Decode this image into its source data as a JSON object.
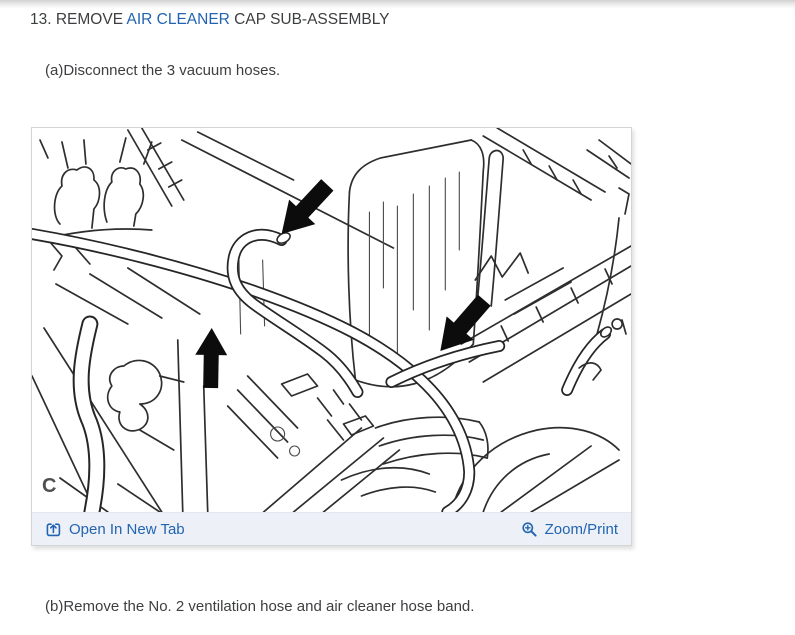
{
  "heading": {
    "prefix": "13. REMOVE ",
    "link": "AIR CLEANER",
    "suffix": " CAP SUB-ASSEMBLY"
  },
  "steps": {
    "a": "(a)Disconnect the 3 vacuum hoses.",
    "b": "(b)Remove the No. 2 ventilation hose and air cleaner hose band."
  },
  "figure": {
    "watermark": "C",
    "alt": "Engine bay line drawing with three solid black arrows pointing to the 3 vacuum hoses at the air cleaner cap",
    "footer": {
      "open_in_new_tab": "Open In New Tab",
      "zoom_print": "Zoom/Print"
    }
  },
  "colors": {
    "link_blue": "#2264b1",
    "body_text": "#3d3e40",
    "footer_bg": "#edf1f7",
    "panel_border": "#d3d4d6",
    "watermark_gray": "#4f5052",
    "arrow_black": "#0c0c0c",
    "line_art": "#2e2e2e"
  }
}
